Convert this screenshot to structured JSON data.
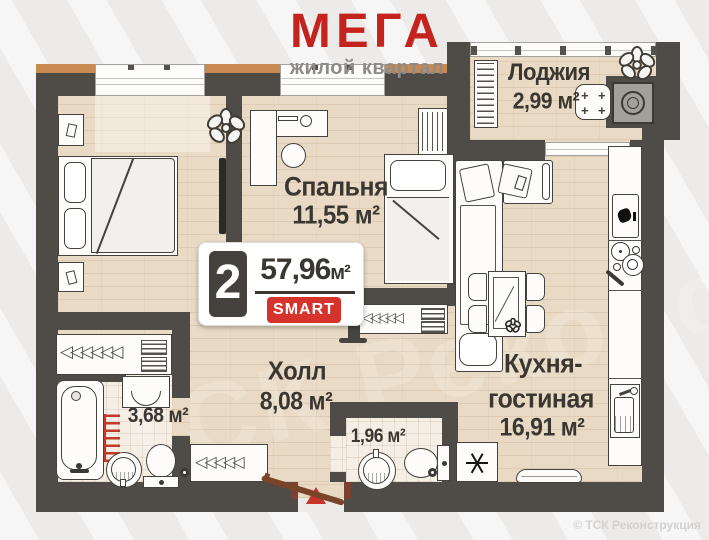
{
  "logo": {
    "title": "МЕГА",
    "subtitle": "жилой квартал"
  },
  "badge": {
    "rooms_count": "2",
    "area_value": "57,96",
    "area_unit": "м²",
    "tag": "SMART"
  },
  "rooms": {
    "loggia": {
      "name": "Лоджия",
      "area": "2,99 м²"
    },
    "bedroom": {
      "name": "Спальня",
      "area": "11,55 м²"
    },
    "hall": {
      "name": "Холл",
      "area": "8,08 м²"
    },
    "kitchen": {
      "name_line1": "Кухня-",
      "name_line2": "гостиная",
      "area": "16,91 м²"
    },
    "bathroom": {
      "area": "3,68 м²"
    },
    "wc": {
      "area": "1,96 м²"
    }
  },
  "watermark": "© ТСК Реконструкция",
  "watermark_large": "ТСК Реконструкция",
  "colors": {
    "wall": "#4f4b46",
    "accent_red": "#c5231d",
    "exterior_orange": "#c98a52",
    "smart_bg": "#d6332c"
  }
}
